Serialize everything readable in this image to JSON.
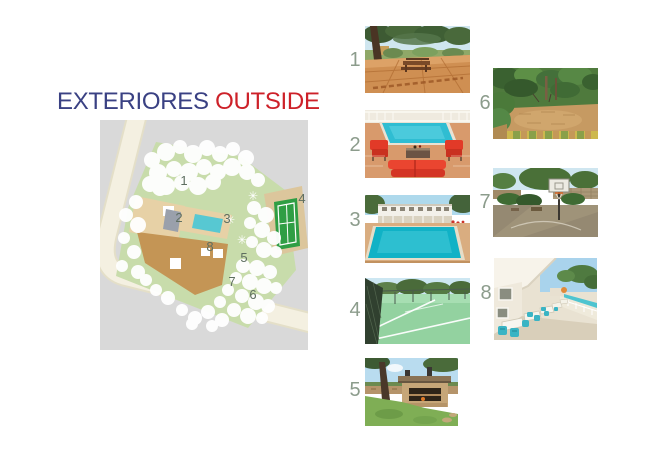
{
  "title": {
    "exteriores": "EXTERIORES",
    "outside": "OUTSIDE"
  },
  "map": {
    "markers": [
      {
        "label": "1"
      },
      {
        "label": "2"
      },
      {
        "label": "3"
      },
      {
        "label": "4"
      },
      {
        "label": "5"
      },
      {
        "label": "6"
      },
      {
        "label": "7"
      },
      {
        "label": "8"
      }
    ]
  },
  "photos": [
    {
      "number": "1",
      "scene": "tiled patio with picnic table under pine trees"
    },
    {
      "number": "2",
      "scene": "pool terrace with red armchairs and double sun lounger"
    },
    {
      "number": "3",
      "scene": "large swimming pool in front of white two-storey house"
    },
    {
      "number": "4",
      "scene": "green tennis court with dark fencing"
    },
    {
      "number": "5",
      "scene": "stone barbecue house beside the lawn"
    },
    {
      "number": "6",
      "scene": "sandy garden clearing surrounded by greenery"
    },
    {
      "number": "7",
      "scene": "basketball hoop on paved court"
    },
    {
      "number": "8",
      "scene": "covered terrace with dining tables beside the pool"
    }
  ],
  "colors": {
    "title_navy": "#3a4183",
    "title_red": "#cd2129",
    "photo_number_gray": "#8c9c8c",
    "map_marker_gray": "#5e6e60",
    "map_background_gray": "#d9d9d9",
    "map_road_cream": "#f4f0e1",
    "map_plot_green": "#c8dcab",
    "map_pool_turquoise": "#57c8d2",
    "map_tennis_green": "#2f9e44",
    "map_building_tan": "#c49555"
  }
}
